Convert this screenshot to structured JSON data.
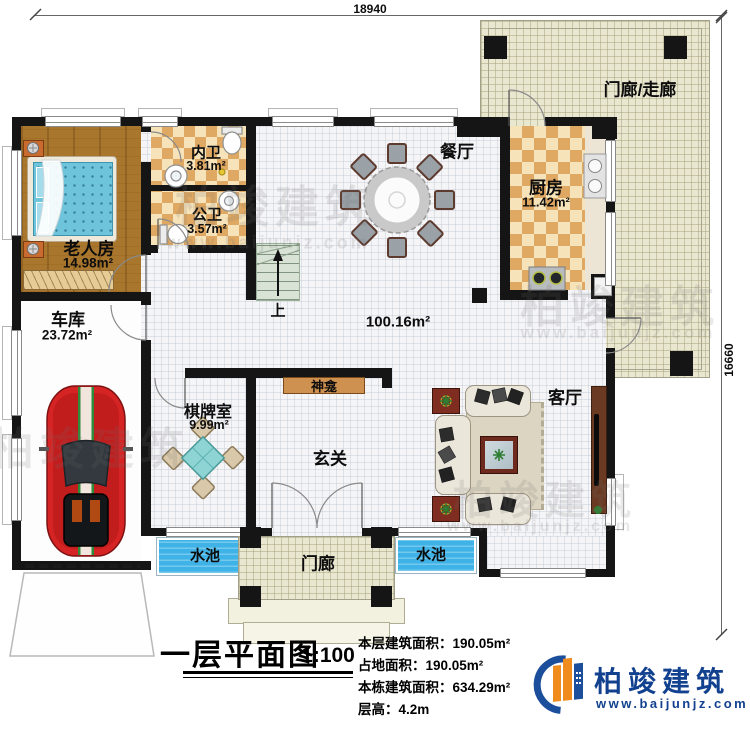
{
  "dimensions": {
    "width_mm": "18940",
    "height_mm": "16660"
  },
  "rooms": {
    "porch_corridor": {
      "label": "门廊/走廊"
    },
    "dining": {
      "label": "餐厅"
    },
    "kitchen": {
      "label": "厨房",
      "area": "11.42m²"
    },
    "inner_bath": {
      "label": "内卫",
      "area": "3.81m²"
    },
    "public_bath": {
      "label": "公卫",
      "area": "3.57m²"
    },
    "elder_bedroom": {
      "label": "老人房",
      "area": "14.98m²"
    },
    "garage": {
      "label": "车库",
      "area": "23.72m²"
    },
    "chess_room": {
      "label": "棋牌室",
      "area": "9.99m²"
    },
    "hall_area": {
      "area": "100.16m²"
    },
    "shrine": {
      "label": "神龛"
    },
    "foyer": {
      "label": "玄关"
    },
    "living": {
      "label": "客厅"
    },
    "stairs": {
      "label": "上"
    },
    "pool_left": {
      "label": "水池"
    },
    "pool_right": {
      "label": "水池"
    },
    "porch_front": {
      "label": "门廊"
    }
  },
  "title_block": {
    "title": "一层平面图",
    "scale": "1:100",
    "stats": [
      "本层建筑面积：190.05m²",
      "占地面积：190.05m²",
      "本栋建筑面积：634.29m²",
      "层高：4.2m"
    ]
  },
  "logo": {
    "name": "柏竣建筑",
    "website": "www.baijunjz.com"
  },
  "watermark": {
    "text": "柏竣建筑",
    "url": "www.baijunjz.com"
  },
  "colors": {
    "wall": "#151515",
    "pool": "#3fb3e7",
    "wood": "#a8762d",
    "checker_dark": "#dfa963",
    "checker_light": "#f6e3ba",
    "porch_tile": "#eae7d0",
    "logo_blue": "#12418f",
    "logo_orange": "#f08c1e",
    "car_red": "#d62424"
  }
}
